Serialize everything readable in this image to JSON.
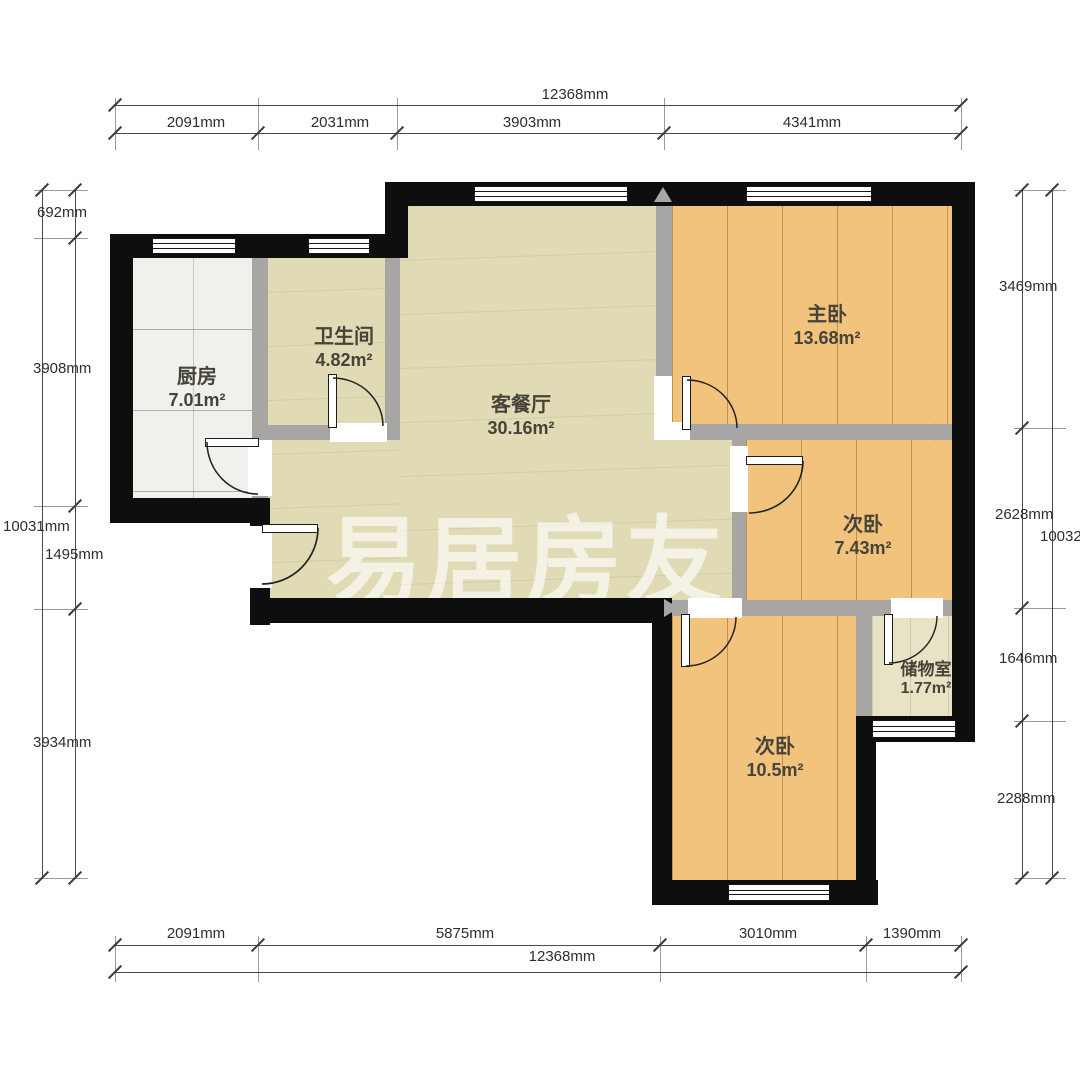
{
  "plan": {
    "watermark": "易居房友",
    "rooms": [
      {
        "name": "厨房",
        "area": "7.01m²"
      },
      {
        "name": "卫生间",
        "area": "4.82m²"
      },
      {
        "name": "客餐厅",
        "area": "30.16m²"
      },
      {
        "name": "主卧",
        "area": "13.68m²"
      },
      {
        "name": "次卧",
        "area": "7.43m²"
      },
      {
        "name": "储物室",
        "area": "1.77m²"
      },
      {
        "name": "次卧",
        "area": "10.5m²"
      }
    ],
    "dimensions": {
      "top": {
        "total": "12368mm",
        "segments": [
          "2091mm",
          "2031mm",
          "3903mm",
          "4341mm"
        ]
      },
      "bottom": {
        "total": "12368mm",
        "segments": [
          "2091mm",
          "5875mm",
          "3010mm",
          "1390mm"
        ]
      },
      "left": {
        "total": "10031mm",
        "segments": [
          "692mm",
          "3908mm",
          "1495mm",
          "3934mm"
        ]
      },
      "right": {
        "total": "10032mm",
        "segments": [
          "3469mm",
          "2628mm",
          "1646mm",
          "2288mm"
        ]
      }
    },
    "colors": {
      "exterior_wall": "#0e0e0e",
      "interior_wall": "#a8a6a4",
      "living_floor": "#e0dbb5",
      "bedroom_floor": "#f2c37c",
      "kitchen_floor": "#f1f0ec",
      "bathroom_floor": "#9c9a97",
      "storage_floor": "#e9e3c6",
      "label_text": "#45433a"
    }
  }
}
